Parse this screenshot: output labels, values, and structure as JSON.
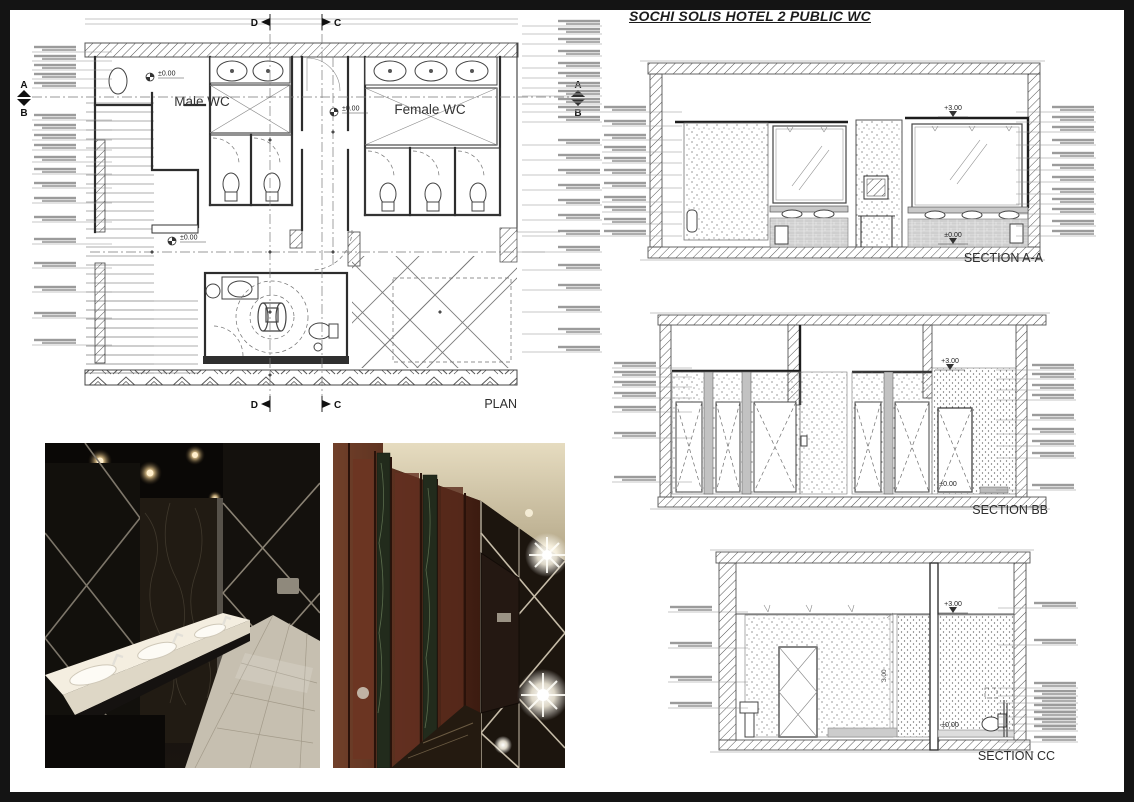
{
  "title": "SOCHI SOLIS HOTEL 2 PUBLIC WC",
  "plan": {
    "label": "PLAN",
    "rooms": {
      "male": "Male WC",
      "female": "Female WC"
    },
    "levels": {
      "vestibule": "±0.00",
      "corridor": "±0.00",
      "lobby": "±0.00"
    },
    "section_markers": {
      "a": "A",
      "b": "B",
      "c": "C",
      "d": "D"
    }
  },
  "sections": {
    "aa": {
      "label": "SECTION A-A",
      "top_level": "+3.00",
      "floor_level": "±0.00"
    },
    "bb": {
      "label": "SECTION BB",
      "top_level": "+3.00",
      "floor_level": "±0.00"
    },
    "cc": {
      "label": "SECTION CC",
      "top_level": "+3.00",
      "floor_level": "±0.00",
      "dim_height": "3.00"
    }
  },
  "colors": {
    "paper": "#ffffff",
    "frame": "#141414",
    "line": "#2e2e2e",
    "hatch": "#555555",
    "annotation": "#7a7a7a",
    "counter_top": "#f4eee0",
    "floor_tile": "#c6bfb0",
    "wood": "#5e2d1c",
    "marble_strip": "#26301d",
    "ceiling_cream": "#ddd3b8",
    "mirror_black": "#14110d",
    "chrome": "#b9b09e",
    "flare": "#fffdf2"
  }
}
